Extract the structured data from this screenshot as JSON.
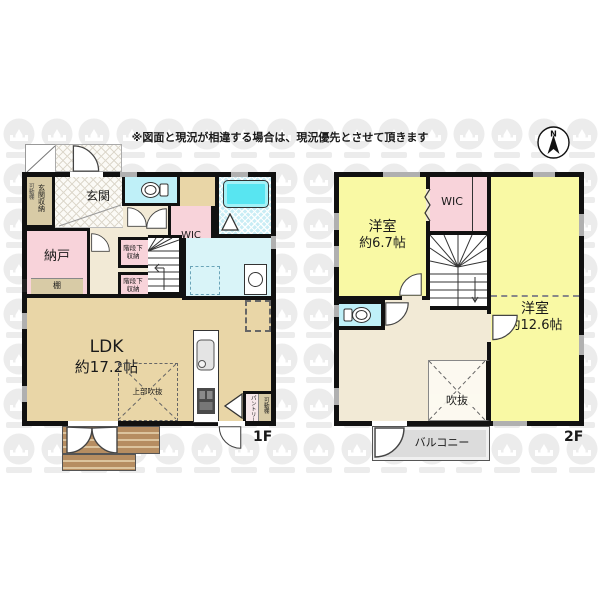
{
  "disclaimer": "※図面と現況が相違する場合は、現況優先とさせて頂きます",
  "compass": {
    "north_label": "N"
  },
  "floor1": {
    "floor_label": "1F",
    "rooms": {
      "entrance": "玄関",
      "entrance_storage": "玄関収納",
      "entrance_movable_shelf": "可動棚",
      "storage_room": "納戸",
      "shelf": "棚",
      "walk_in_closet": "WIC",
      "under_stair_storage_1": "階段下収納",
      "under_stair_storage_2": "階段下収納",
      "ldk_name": "LDK",
      "ldk_size": "約17.2帖",
      "open_ceiling_above": "上部吹抜",
      "pantry": "パントリー",
      "pantry_movable_shelf": "可動棚"
    }
  },
  "floor2": {
    "floor_label": "2F",
    "rooms": {
      "bedroom_1_name": "洋室",
      "bedroom_1_size": "約6.7帖",
      "walk_in_closet": "WIC",
      "bedroom_2_name": "洋室",
      "bedroom_2_size": "約12.6帖",
      "void": "吹抜",
      "balcony": "バルコニー"
    }
  },
  "colors": {
    "wall": "#111111",
    "room_pink": "#f8d3da",
    "room_yellow": "#f9f9a4",
    "ldk_tan": "#e9d6a7",
    "hall_cream": "#f2ead6",
    "sanitary_cyan": "#bff0f8",
    "bathtub_cyan": "#58e5f1",
    "washroom_cyan": "#d9f4f8",
    "storage_khaki": "#d8cba6",
    "deck_brown": "#b68d61",
    "balcony_gray": "#dcdcdc",
    "window_gray": "#b0b0b0",
    "watermark_gray": "#ececec"
  }
}
